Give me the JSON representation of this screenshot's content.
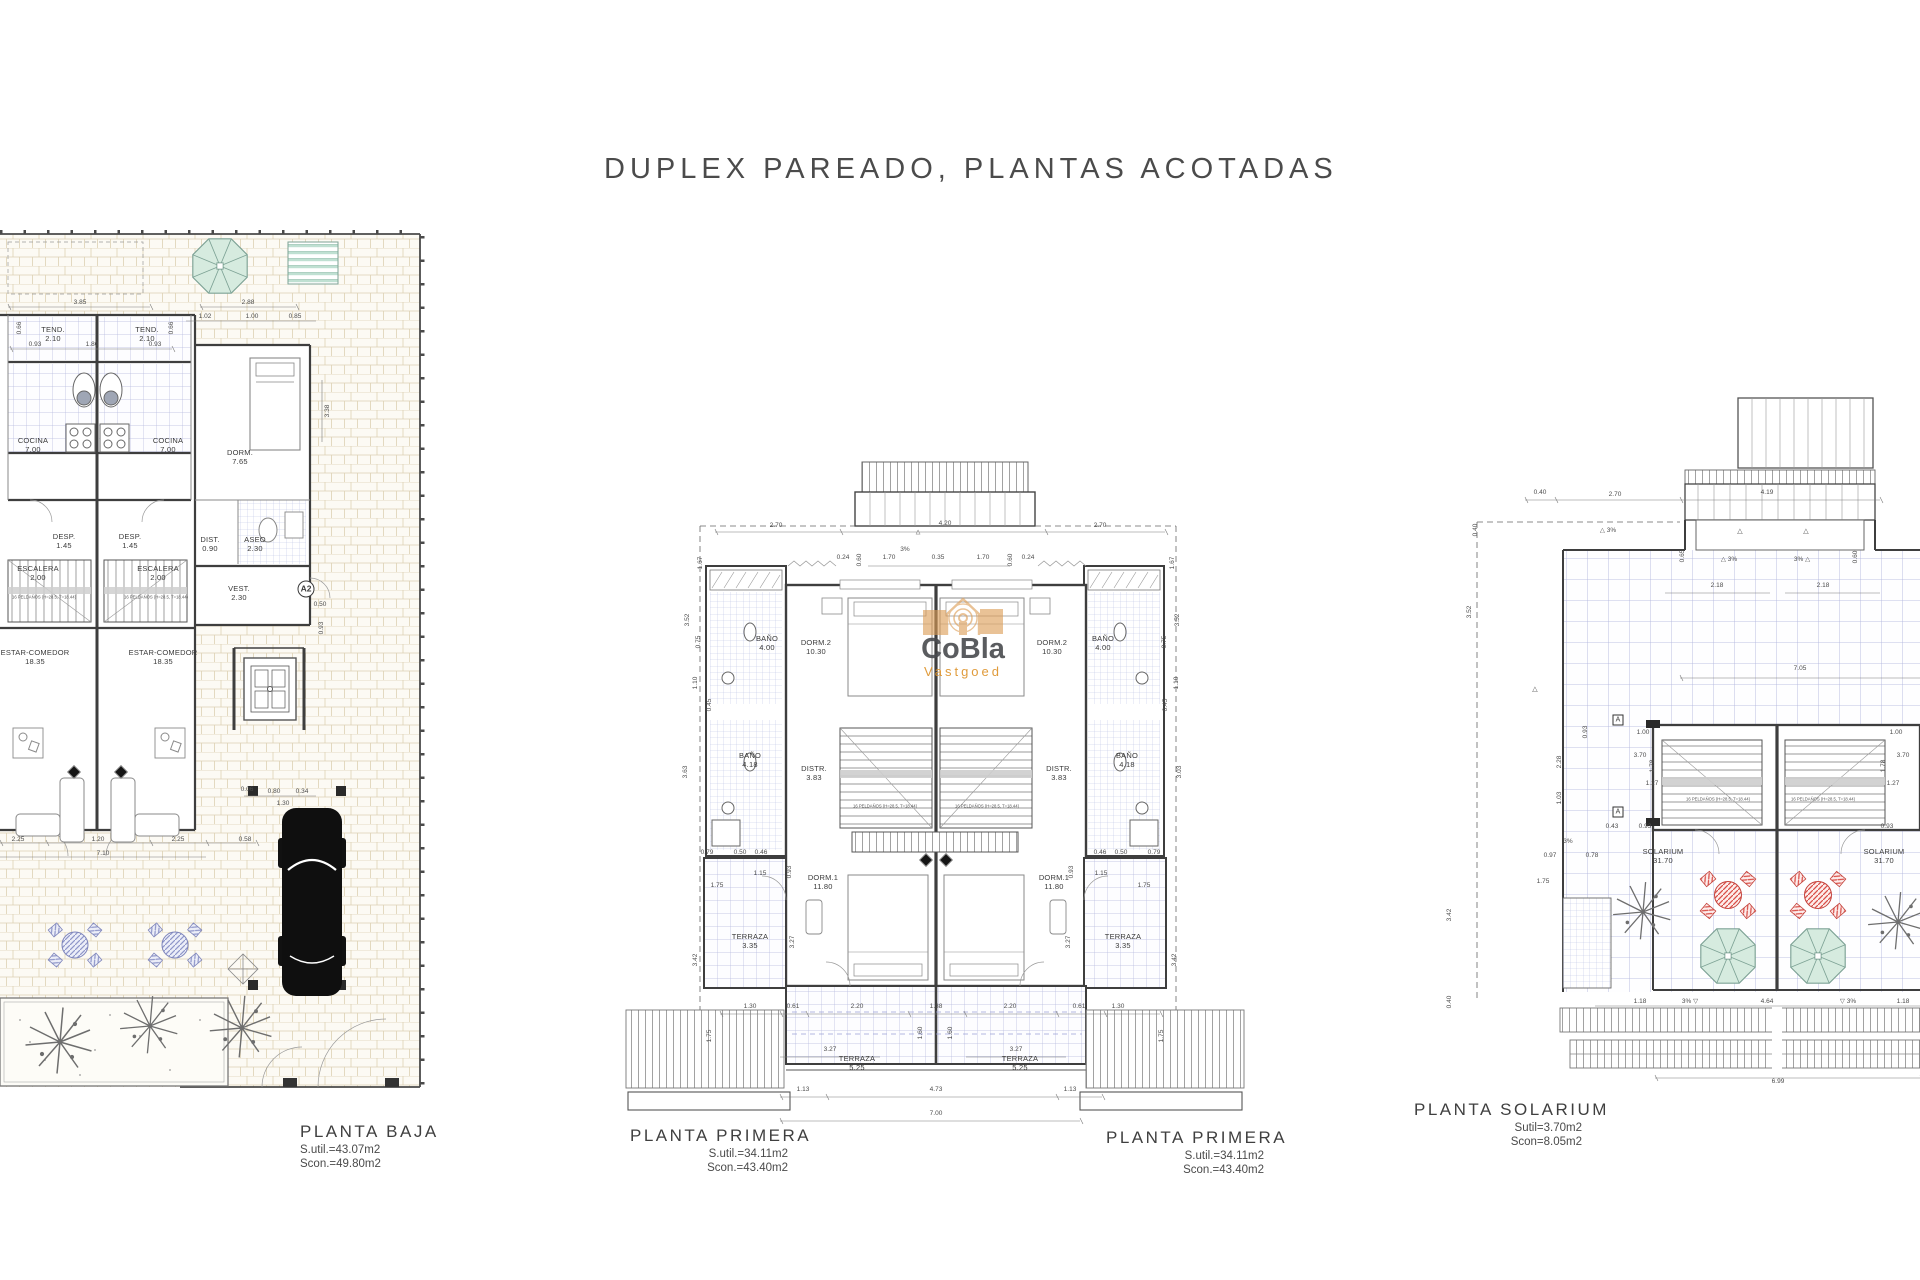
{
  "title": "DUPLEX PAREADO, PLANTAS ACOTADAS",
  "watermark": {
    "name": "CoBla",
    "sub": "Vastgoed"
  },
  "captions": {
    "baja": {
      "name": "PLANTA BAJA",
      "sutil": "S.util.=43.07m2",
      "scon": "Scon.=49.80m2"
    },
    "primera_left": {
      "name": "PLANTA PRIMERA",
      "sutil": "S.util.=34.11m2",
      "scon": "Scon.=43.40m2"
    },
    "primera_right": {
      "name": "PLANTA PRIMERA",
      "sutil": "S.util.=34.11m2",
      "scon": "Scon.=43.40m2"
    },
    "solarium": {
      "name": "PLANTA SOLARIUM",
      "sutil": "Sutil=3.70m2",
      "scon": "Scon=8.05m2"
    }
  },
  "planta_baja": {
    "labels": [
      {
        "t": "TEND.\n2.10",
        "x": 53,
        "y": 105,
        "c": "room"
      },
      {
        "t": "TEND.\n2.10",
        "x": 147,
        "y": 105,
        "c": "room"
      },
      {
        "t": "COCINA\n7.00",
        "x": 33,
        "y": 216,
        "c": "room"
      },
      {
        "t": "COCINA\n7.00",
        "x": 168,
        "y": 216,
        "c": "room"
      },
      {
        "t": "DORM.\n7.65",
        "x": 240,
        "y": 228,
        "c": "room"
      },
      {
        "t": "DESP.\n1.45",
        "x": 64,
        "y": 312,
        "c": "room"
      },
      {
        "t": "DESP.\n1.45",
        "x": 130,
        "y": 312,
        "c": "room"
      },
      {
        "t": "DIST.\n0.90",
        "x": 210,
        "y": 315,
        "c": "room"
      },
      {
        "t": "ASEO\n2.30",
        "x": 255,
        "y": 315,
        "c": "room"
      },
      {
        "t": "ESCALERA\n2.00",
        "x": 38,
        "y": 344,
        "c": "room"
      },
      {
        "t": "ESCALERA\n2.00",
        "x": 158,
        "y": 344,
        "c": "room"
      },
      {
        "t": "16 PELDAÑOS (H=28.5, T=18.44)",
        "x": 44,
        "y": 368,
        "c": "note"
      },
      {
        "t": "16 PELDAÑOS (H=28.5, T=18.44)",
        "x": 156,
        "y": 368,
        "c": "note"
      },
      {
        "t": "VEST.\n2.30",
        "x": 239,
        "y": 364,
        "c": "room"
      },
      {
        "t": "A2",
        "x": 306,
        "y": 359,
        "c": "badge"
      },
      {
        "t": "ESTAR-COMEDOR\n18.35",
        "x": 35,
        "y": 428,
        "c": "room"
      },
      {
        "t": "ESTAR-COMEDOR\n18.35",
        "x": 163,
        "y": 428,
        "c": "room"
      },
      {
        "t": "3.85",
        "x": 80,
        "y": 73,
        "c": "dim"
      },
      {
        "t": "2.88",
        "x": 248,
        "y": 73,
        "c": "dim"
      },
      {
        "t": "1.02",
        "x": 205,
        "y": 87,
        "c": "dim"
      },
      {
        "t": "1.00",
        "x": 252,
        "y": 87,
        "c": "dim"
      },
      {
        "t": "0.85",
        "x": 295,
        "y": 87,
        "c": "dim"
      },
      {
        "t": "0.93",
        "x": 35,
        "y": 115,
        "c": "dim"
      },
      {
        "t": "1.80",
        "x": 92,
        "y": 115,
        "c": "dim"
      },
      {
        "t": "0.93",
        "x": 155,
        "y": 115,
        "c": "dim"
      },
      {
        "t": "0.66",
        "x": 20,
        "y": 98,
        "r": -90,
        "c": "dim"
      },
      {
        "t": "0.66",
        "x": 172,
        "y": 98,
        "r": -90,
        "c": "dim"
      },
      {
        "t": "3.38",
        "x": 328,
        "y": 181,
        "r": -90,
        "c": "dim"
      },
      {
        "t": "0.50",
        "x": 320,
        "y": 375,
        "c": "dim"
      },
      {
        "t": "0.93",
        "x": 322,
        "y": 398,
        "r": -90,
        "c": "dim"
      },
      {
        "t": "0.06",
        "x": 247,
        "y": 560,
        "c": "dim"
      },
      {
        "t": "0.80",
        "x": 274,
        "y": 562,
        "c": "dim"
      },
      {
        "t": "0.34",
        "x": 302,
        "y": 562,
        "c": "dim"
      },
      {
        "t": "1.30",
        "x": 283,
        "y": 574,
        "c": "dim"
      },
      {
        "t": "2.25",
        "x": 18,
        "y": 610,
        "c": "dim"
      },
      {
        "t": "1.20",
        "x": 98,
        "y": 610,
        "c": "dim"
      },
      {
        "t": "2.25",
        "x": 178,
        "y": 610,
        "c": "dim"
      },
      {
        "t": "0.58",
        "x": 245,
        "y": 610,
        "c": "dim"
      },
      {
        "t": "7.10",
        "x": 103,
        "y": 624,
        "c": "dim"
      }
    ]
  },
  "planta_primera": {
    "labels": [
      {
        "t": "BAÑO\n4.00",
        "x": 167,
        "y": 264,
        "c": "room"
      },
      {
        "t": "BAÑO\n4.00",
        "x": 503,
        "y": 264,
        "c": "room"
      },
      {
        "t": "DORM.2\n10.30",
        "x": 216,
        "y": 268,
        "c": "room"
      },
      {
        "t": "DORM.2\n10.30",
        "x": 452,
        "y": 268,
        "c": "room"
      },
      {
        "t": "BAÑO\n4.18",
        "x": 150,
        "y": 381,
        "c": "room"
      },
      {
        "t": "BAÑO\n4.18",
        "x": 527,
        "y": 381,
        "c": "room"
      },
      {
        "t": "DISTR.\n3.83",
        "x": 214,
        "y": 394,
        "c": "room"
      },
      {
        "t": "DISTR.\n3.83",
        "x": 459,
        "y": 394,
        "c": "room"
      },
      {
        "t": "16 PELDAÑOS (H=28.5, T=18.44)",
        "x": 285,
        "y": 427,
        "c": "note"
      },
      {
        "t": "16 PELDAÑOS (H=28.5, T=18.44)",
        "x": 387,
        "y": 427,
        "c": "note"
      },
      {
        "t": "DORM.1\n11.80",
        "x": 223,
        "y": 503,
        "c": "room"
      },
      {
        "t": "DORM.1\n11.80",
        "x": 454,
        "y": 503,
        "c": "room"
      },
      {
        "t": "TERRAZA\n3.35",
        "x": 150,
        "y": 562,
        "c": "room"
      },
      {
        "t": "TERRAZA\n3.35",
        "x": 523,
        "y": 562,
        "c": "room"
      },
      {
        "t": "TERRAZA\n5.25",
        "x": 257,
        "y": 684,
        "c": "room"
      },
      {
        "t": "TERRAZA\n5.25",
        "x": 420,
        "y": 684,
        "c": "room"
      },
      {
        "t": "2.70",
        "x": 176,
        "y": 146,
        "c": "dim"
      },
      {
        "t": "4.20",
        "x": 345,
        "y": 144,
        "c": "dim"
      },
      {
        "t": "2.70",
        "x": 500,
        "y": 146,
        "c": "dim"
      },
      {
        "t": "△",
        "x": 318,
        "y": 153,
        "fs": 6,
        "c": "dim"
      },
      {
        "t": "3%",
        "x": 305,
        "y": 170,
        "c": "dim"
      },
      {
        "t": "1.70",
        "x": 289,
        "y": 178,
        "c": "dim"
      },
      {
        "t": "0.35",
        "x": 338,
        "y": 178,
        "c": "dim"
      },
      {
        "t": "1.70",
        "x": 383,
        "y": 178,
        "c": "dim"
      },
      {
        "t": "0.24",
        "x": 243,
        "y": 178,
        "c": "dim"
      },
      {
        "t": "0.24",
        "x": 428,
        "y": 178,
        "c": "dim"
      },
      {
        "t": "0.60",
        "x": 260,
        "y": 180,
        "r": -90,
        "c": "dim"
      },
      {
        "t": "0.60",
        "x": 411,
        "y": 180,
        "r": -90,
        "c": "dim"
      },
      {
        "t": "1.67",
        "x": 101,
        "y": 183,
        "r": -90,
        "c": "dim"
      },
      {
        "t": "1.67",
        "x": 573,
        "y": 183,
        "r": -90,
        "c": "dim"
      },
      {
        "t": "3.52",
        "x": 88,
        "y": 240,
        "r": -90,
        "c": "dim"
      },
      {
        "t": "3.52",
        "x": 578,
        "y": 240,
        "r": -90,
        "c": "dim"
      },
      {
        "t": "0.75",
        "x": 99,
        "y": 262,
        "r": -90,
        "c": "dim"
      },
      {
        "t": "0.75",
        "x": 565,
        "y": 262,
        "r": -90,
        "c": "dim"
      },
      {
        "t": "1.10",
        "x": 96,
        "y": 303,
        "r": -90,
        "c": "dim"
      },
      {
        "t": "1.10",
        "x": 577,
        "y": 303,
        "r": -90,
        "c": "dim"
      },
      {
        "t": "0.45",
        "x": 110,
        "y": 325,
        "r": -90,
        "c": "dim"
      },
      {
        "t": "0.45",
        "x": 566,
        "y": 325,
        "r": -90,
        "c": "dim"
      },
      {
        "t": "3.63",
        "x": 86,
        "y": 392,
        "r": -90,
        "c": "dim"
      },
      {
        "t": "3.03",
        "x": 580,
        "y": 392,
        "r": -90,
        "c": "dim"
      },
      {
        "t": "0.79",
        "x": 107,
        "y": 473,
        "c": "dim"
      },
      {
        "t": "0.50",
        "x": 140,
        "y": 473,
        "c": "dim"
      },
      {
        "t": "0.46",
        "x": 161,
        "y": 473,
        "c": "dim"
      },
      {
        "t": "0.46",
        "x": 500,
        "y": 473,
        "c": "dim"
      },
      {
        "t": "0.50",
        "x": 521,
        "y": 473,
        "c": "dim"
      },
      {
        "t": "0.79",
        "x": 554,
        "y": 473,
        "c": "dim"
      },
      {
        "t": "1.15",
        "x": 160,
        "y": 494,
        "c": "dim"
      },
      {
        "t": "1.15",
        "x": 501,
        "y": 494,
        "c": "dim"
      },
      {
        "t": "0.93",
        "x": 190,
        "y": 492,
        "r": -90,
        "c": "dim"
      },
      {
        "t": "0.93",
        "x": 472,
        "y": 492,
        "r": -90,
        "c": "dim"
      },
      {
        "t": "1.75",
        "x": 117,
        "y": 506,
        "c": "dim"
      },
      {
        "t": "1.75",
        "x": 544,
        "y": 506,
        "c": "dim"
      },
      {
        "t": "3.27",
        "x": 193,
        "y": 562,
        "r": -90,
        "c": "dim"
      },
      {
        "t": "3.27",
        "x": 469,
        "y": 562,
        "r": -90,
        "c": "dim"
      },
      {
        "t": "3.42",
        "x": 96,
        "y": 580,
        "r": -90,
        "c": "dim"
      },
      {
        "t": "3.42",
        "x": 575,
        "y": 580,
        "r": -90,
        "c": "dim"
      },
      {
        "t": "1.30",
        "x": 150,
        "y": 627,
        "c": "dim"
      },
      {
        "t": "0.61",
        "x": 193,
        "y": 627,
        "c": "dim"
      },
      {
        "t": "2.20",
        "x": 257,
        "y": 627,
        "c": "dim"
      },
      {
        "t": "1.38",
        "x": 336,
        "y": 627,
        "c": "dim"
      },
      {
        "t": "2.20",
        "x": 410,
        "y": 627,
        "c": "dim"
      },
      {
        "t": "0.61",
        "x": 479,
        "y": 627,
        "c": "dim"
      },
      {
        "t": "1.30",
        "x": 518,
        "y": 627,
        "c": "dim"
      },
      {
        "t": "1.60",
        "x": 321,
        "y": 653,
        "r": -90,
        "c": "dim"
      },
      {
        "t": "1.60",
        "x": 351,
        "y": 653,
        "r": -90,
        "c": "dim"
      },
      {
        "t": "3.27",
        "x": 230,
        "y": 670,
        "c": "dim"
      },
      {
        "t": "3.27",
        "x": 416,
        "y": 670,
        "c": "dim"
      },
      {
        "t": "1.75",
        "x": 110,
        "y": 656,
        "r": -90,
        "c": "dim"
      },
      {
        "t": "1.75",
        "x": 562,
        "y": 656,
        "r": -90,
        "c": "dim"
      },
      {
        "t": "1.13",
        "x": 203,
        "y": 710,
        "c": "dim"
      },
      {
        "t": "4.73",
        "x": 336,
        "y": 710,
        "c": "dim"
      },
      {
        "t": "1.13",
        "x": 470,
        "y": 710,
        "c": "dim"
      },
      {
        "t": "7.00",
        "x": 336,
        "y": 734,
        "c": "dim"
      }
    ]
  },
  "planta_solarium": {
    "labels": [
      {
        "t": "SOLARIUM\n31.70",
        "x": 223,
        "y": 467,
        "c": "room"
      },
      {
        "t": "SOLARIUM\n31.70",
        "x": 444,
        "y": 467,
        "c": "room"
      },
      {
        "t": "16 PELDAÑOS (H=28.5, T=18.44)",
        "x": 278,
        "y": 410,
        "c": "note"
      },
      {
        "t": "16 PELDAÑOS (H=28.5, T=18.44)",
        "x": 383,
        "y": 410,
        "c": "note"
      },
      {
        "t": "A",
        "x": 178,
        "y": 330,
        "c": "badgesq"
      },
      {
        "t": "A",
        "x": 178,
        "y": 422,
        "c": "badgesq"
      },
      {
        "t": "0.40",
        "x": 100,
        "y": 103,
        "c": "dim"
      },
      {
        "t": "2.70",
        "x": 175,
        "y": 105,
        "c": "dim"
      },
      {
        "t": "4.19",
        "x": 327,
        "y": 103,
        "c": "dim"
      },
      {
        "t": "0.40",
        "x": 36,
        "y": 140,
        "r": -90,
        "c": "dim"
      },
      {
        "t": "△ 3%",
        "x": 168,
        "y": 141,
        "c": "dim"
      },
      {
        "t": "△",
        "x": 300,
        "y": 142,
        "fs": 7,
        "c": "dim"
      },
      {
        "t": "△",
        "x": 366,
        "y": 142,
        "fs": 7,
        "c": "dim"
      },
      {
        "t": "0.65",
        "x": 243,
        "y": 166,
        "r": -90,
        "c": "dim"
      },
      {
        "t": "△ 3%",
        "x": 289,
        "y": 170,
        "c": "dim"
      },
      {
        "t": "3% △",
        "x": 362,
        "y": 170,
        "c": "dim"
      },
      {
        "t": "0.60",
        "x": 416,
        "y": 167,
        "r": -90,
        "c": "dim"
      },
      {
        "t": "2.18",
        "x": 277,
        "y": 196,
        "c": "dim"
      },
      {
        "t": "2.18",
        "x": 383,
        "y": 196,
        "c": "dim"
      },
      {
        "t": "3.52",
        "x": 30,
        "y": 222,
        "r": -90,
        "c": "dim"
      },
      {
        "t": "7.05",
        "x": 360,
        "y": 279,
        "c": "dim"
      },
      {
        "t": "△",
        "x": 95,
        "y": 300,
        "fs": 7,
        "c": "dim"
      },
      {
        "t": "0.93",
        "x": 146,
        "y": 342,
        "r": -90,
        "c": "dim"
      },
      {
        "t": "2.28",
        "x": 120,
        "y": 372,
        "r": -90,
        "c": "dim"
      },
      {
        "t": "1.03",
        "x": 120,
        "y": 408,
        "r": -90,
        "c": "dim"
      },
      {
        "t": "1.00",
        "x": 203,
        "y": 343,
        "c": "dim"
      },
      {
        "t": "1.00",
        "x": 456,
        "y": 343,
        "c": "dim"
      },
      {
        "t": "3.70",
        "x": 200,
        "y": 366,
        "c": "dim"
      },
      {
        "t": "3.70",
        "x": 463,
        "y": 366,
        "c": "dim"
      },
      {
        "t": "1.78",
        "x": 213,
        "y": 376,
        "r": -90,
        "c": "dim"
      },
      {
        "t": "1.78",
        "x": 444,
        "y": 376,
        "r": -90,
        "c": "dim"
      },
      {
        "t": "1.27",
        "x": 212,
        "y": 394,
        "c": "dim"
      },
      {
        "t": "1.27",
        "x": 453,
        "y": 394,
        "c": "dim"
      },
      {
        "t": "3%",
        "x": 128,
        "y": 452,
        "c": "dim"
      },
      {
        "t": "0.43",
        "x": 172,
        "y": 437,
        "c": "dim"
      },
      {
        "t": "0.93",
        "x": 205,
        "y": 437,
        "c": "dim"
      },
      {
        "t": "0.93",
        "x": 447,
        "y": 437,
        "c": "dim"
      },
      {
        "t": "0.97",
        "x": 110,
        "y": 466,
        "c": "dim"
      },
      {
        "t": "0.78",
        "x": 152,
        "y": 466,
        "c": "dim"
      },
      {
        "t": "1.75",
        "x": 103,
        "y": 492,
        "c": "dim"
      },
      {
        "t": "3.42",
        "x": 10,
        "y": 525,
        "r": -90,
        "c": "dim"
      },
      {
        "t": "0.40",
        "x": 10,
        "y": 612,
        "r": -90,
        "c": "dim"
      },
      {
        "t": "1.18",
        "x": 200,
        "y": 612,
        "c": "dim"
      },
      {
        "t": "3% ▽",
        "x": 250,
        "y": 612,
        "c": "dim"
      },
      {
        "t": "4.64",
        "x": 327,
        "y": 612,
        "c": "dim"
      },
      {
        "t": "▽ 3%",
        "x": 408,
        "y": 612,
        "c": "dim"
      },
      {
        "t": "1.18",
        "x": 463,
        "y": 612,
        "c": "dim"
      },
      {
        "t": "6.99",
        "x": 338,
        "y": 692,
        "c": "dim"
      }
    ]
  }
}
